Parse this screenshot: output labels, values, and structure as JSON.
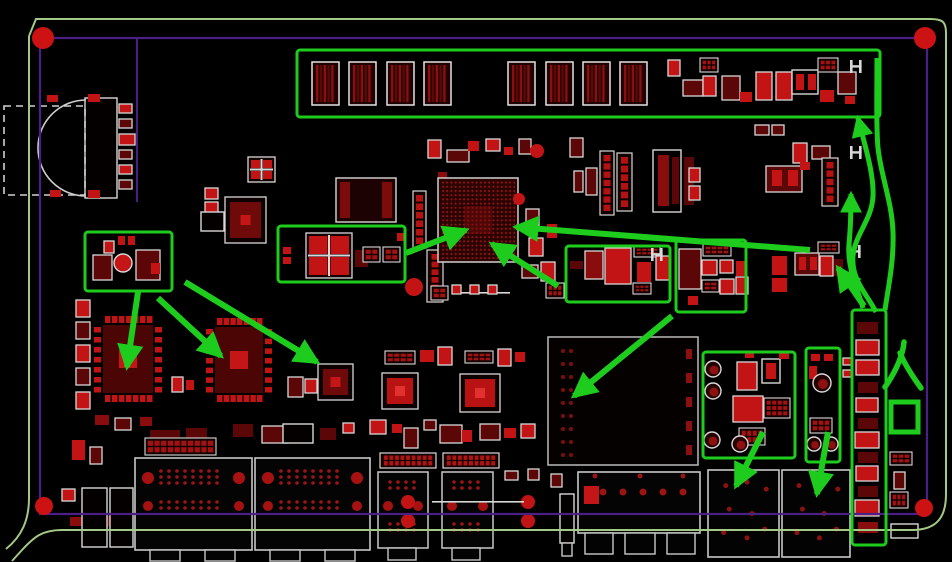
{
  "scene": {
    "width": 952,
    "height": 562,
    "background": "#000000"
  },
  "colors": {
    "annotation_green": "#1ecc1e",
    "board_outline_green": "#a4c985",
    "keepout_purple": "#4a2086",
    "pad_bright_red": "#c21414",
    "pad_mid_red": "#8a0d0d",
    "pad_dark_red": "#5c0707",
    "silk_white": "#d8d8d8",
    "hole_red": "#cc1212",
    "bga_dot_red": "#921414"
  },
  "board": {
    "outline_paths": [
      "M 29,36 L 36,19 L 930,19 C 943,19 946,22 946,33 L 946,494 C 946,516 938,530 912,530 L 62,530 C 42,530 34,537 22,550 L 12,561",
      "M 29,36 L 29,498 C 29,520 22,536 6,549"
    ],
    "keepout_rect": [
      40,
      38,
      887,
      476
    ],
    "trace_line": [
      137,
      38,
      137,
      202
    ],
    "mount_holes": [
      [
        43,
        38,
        11
      ],
      [
        925,
        38,
        11
      ],
      [
        44,
        506,
        9
      ],
      [
        924,
        508,
        9
      ]
    ]
  },
  "components": [
    [
      "wr",
      85,
      98,
      32,
      100
    ],
    [
      "arc",
      86,
      100,
      0,
      96
    ],
    [
      "dr",
      4,
      106,
      81,
      89
    ],
    [
      "p",
      88,
      94,
      12,
      8,
      1
    ],
    [
      "p",
      88,
      190,
      12,
      8,
      1
    ],
    [
      "p",
      47,
      95,
      11,
      7,
      1
    ],
    [
      "p",
      50,
      190,
      11,
      7,
      1
    ],
    [
      "w",
      119,
      104,
      13,
      9,
      1
    ],
    [
      "w",
      119,
      119,
      13,
      9,
      0
    ],
    [
      "w",
      119,
      134,
      16,
      11,
      1
    ],
    [
      "w",
      119,
      150,
      13,
      9,
      0
    ],
    [
      "w",
      119,
      165,
      13,
      9,
      1
    ],
    [
      "w",
      119,
      180,
      13,
      9,
      0
    ],
    [
      "t",
      312,
      62,
      27,
      43
    ],
    [
      "t",
      349,
      62,
      27,
      43
    ],
    [
      "t",
      387,
      62,
      27,
      43
    ],
    [
      "t",
      424,
      62,
      27,
      43
    ],
    [
      "t",
      508,
      62,
      27,
      43
    ],
    [
      "t",
      546,
      62,
      27,
      43
    ],
    [
      "t",
      583,
      62,
      27,
      43
    ],
    [
      "t",
      620,
      62,
      27,
      43
    ],
    [
      "w",
      668,
      60,
      12,
      16,
      1
    ],
    [
      "w",
      683,
      80,
      20,
      16,
      0
    ],
    [
      "g",
      700,
      58,
      18,
      14
    ],
    [
      "w",
      703,
      76,
      13,
      20,
      1
    ],
    [
      "w",
      722,
      76,
      18,
      24,
      0
    ],
    [
      "p",
      740,
      92,
      12,
      10,
      1
    ],
    [
      "w",
      756,
      72,
      16,
      28,
      1
    ],
    [
      "w",
      776,
      72,
      16,
      28,
      1
    ],
    [
      "wr",
      792,
      70,
      26,
      24
    ],
    [
      "p",
      796,
      74,
      8,
      16,
      1
    ],
    [
      "p",
      808,
      74,
      8,
      16,
      1
    ],
    [
      "g",
      818,
      58,
      20,
      14
    ],
    [
      "p",
      820,
      90,
      14,
      12,
      1
    ],
    [
      "w",
      838,
      72,
      18,
      22,
      0
    ],
    [
      "H",
      850,
      60
    ],
    [
      "p",
      845,
      96,
      10,
      8,
      1
    ],
    [
      "w",
      428,
      140,
      13,
      18,
      1
    ],
    [
      "w",
      447,
      150,
      22,
      12,
      0
    ],
    [
      "p",
      468,
      141,
      11,
      10,
      1
    ],
    [
      "w",
      486,
      139,
      14,
      12,
      1
    ],
    [
      "p",
      504,
      147,
      9,
      8,
      1
    ],
    [
      "w",
      519,
      139,
      12,
      15,
      0
    ],
    [
      "cr",
      537,
      151,
      7,
      0,
      1
    ],
    [
      "w",
      570,
      138,
      13,
      19,
      0
    ],
    [
      "x4",
      248,
      157,
      27,
      25
    ],
    [
      "w",
      205,
      188,
      13,
      11,
      1
    ],
    [
      "w",
      205,
      202,
      13,
      11,
      1
    ],
    [
      "qfn",
      225,
      197,
      41,
      46,
      0
    ],
    [
      "wr",
      201,
      212,
      23,
      19
    ],
    [
      "c2",
      336,
      178,
      60,
      44
    ],
    [
      "hv",
      413,
      191,
      13,
      57
    ],
    [
      "p",
      438,
      172,
      9,
      76,
      2
    ],
    [
      "p",
      118,
      236,
      7,
      9,
      1
    ],
    [
      "p",
      128,
      236,
      7,
      9,
      1
    ],
    [
      "cy",
      123,
      263,
      9
    ],
    [
      "w",
      93,
      255,
      19,
      25,
      0
    ],
    [
      "w",
      136,
      250,
      24,
      30,
      0
    ],
    [
      "p",
      151,
      263,
      9,
      11,
      1
    ],
    [
      "w",
      104,
      241,
      10,
      12,
      1
    ],
    [
      "w",
      76,
      300,
      14,
      17,
      1
    ],
    [
      "w",
      76,
      322,
      14,
      17,
      0
    ],
    [
      "w",
      76,
      345,
      14,
      17,
      1
    ],
    [
      "w",
      76,
      368,
      14,
      17,
      0
    ],
    [
      "w",
      76,
      392,
      14,
      17,
      1
    ],
    [
      "qfp",
      94,
      316,
      68,
      86
    ],
    [
      "qfp",
      206,
      318,
      66,
      84
    ],
    [
      "qfn",
      318,
      364,
      35,
      36,
      0
    ],
    [
      "w",
      172,
      377,
      11,
      15,
      1
    ],
    [
      "p",
      186,
      380,
      8,
      10,
      1
    ],
    [
      "w",
      288,
      377,
      15,
      20,
      0
    ],
    [
      "w",
      305,
      379,
      12,
      14,
      1
    ],
    [
      "p",
      283,
      247,
      8,
      7,
      1
    ],
    [
      "p",
      283,
      257,
      8,
      7,
      1
    ],
    [
      "x4",
      306,
      233,
      46,
      45
    ],
    [
      "p",
      355,
      250,
      13,
      17,
      0
    ],
    [
      "g",
      363,
      247,
      17,
      15
    ],
    [
      "g",
      383,
      247,
      17,
      15
    ],
    [
      "p",
      397,
      233,
      8,
      8,
      1
    ],
    [
      "cr",
      414,
      287,
      9,
      0,
      1
    ],
    [
      "hv",
      427,
      250,
      16,
      52
    ],
    [
      "bga",
      438,
      178,
      80,
      84
    ],
    [
      "w",
      526,
      209,
      13,
      22,
      0
    ],
    [
      "w",
      529,
      238,
      14,
      18,
      1
    ],
    [
      "p",
      547,
      224,
      10,
      14,
      1
    ],
    [
      "cr",
      519,
      199,
      6,
      0,
      1
    ],
    [
      "w",
      522,
      265,
      16,
      13,
      0
    ],
    [
      "w",
      541,
      262,
      14,
      19,
      1
    ],
    [
      "hv",
      600,
      151,
      14,
      64
    ],
    [
      "hv",
      617,
      153,
      15,
      58
    ],
    [
      "wr",
      653,
      150,
      28,
      62
    ],
    [
      "p",
      658,
      155,
      11,
      51,
      2
    ],
    [
      "p",
      672,
      157,
      7,
      47,
      0
    ],
    [
      "p",
      684,
      157,
      10,
      48,
      0
    ],
    [
      "w",
      689,
      168,
      11,
      14,
      1
    ],
    [
      "w",
      689,
      186,
      11,
      14,
      1
    ],
    [
      "w",
      574,
      171,
      9,
      21,
      0
    ],
    [
      "w",
      586,
      168,
      11,
      27,
      0
    ],
    [
      "ln",
      452,
      292,
      58,
      0
    ],
    [
      "g",
      431,
      286,
      17,
      14
    ],
    [
      "w",
      452,
      285,
      9,
      9,
      1
    ],
    [
      "w",
      470,
      285,
      9,
      9,
      1
    ],
    [
      "w",
      488,
      285,
      9,
      9,
      1
    ],
    [
      "g",
      546,
      283,
      18,
      15
    ],
    [
      "qfn",
      382,
      373,
      36,
      36,
      1
    ],
    [
      "qfn",
      460,
      374,
      40,
      38,
      1
    ],
    [
      "g",
      385,
      351,
      30,
      13
    ],
    [
      "p",
      420,
      350,
      14,
      12,
      1
    ],
    [
      "w",
      438,
      347,
      14,
      18,
      1
    ],
    [
      "g",
      465,
      351,
      28,
      12
    ],
    [
      "w",
      498,
      349,
      13,
      17,
      1
    ],
    [
      "p",
      515,
      352,
      10,
      10,
      1
    ],
    [
      "w",
      370,
      420,
      16,
      14,
      1
    ],
    [
      "p",
      392,
      424,
      10,
      9,
      1
    ],
    [
      "w",
      404,
      428,
      14,
      20,
      0
    ],
    [
      "w",
      424,
      420,
      12,
      10,
      0
    ],
    [
      "w",
      440,
      425,
      22,
      18,
      0
    ],
    [
      "p",
      462,
      430,
      10,
      12,
      1
    ],
    [
      "w",
      480,
      424,
      20,
      16,
      0
    ],
    [
      "p",
      504,
      428,
      12,
      10,
      1
    ],
    [
      "w",
      521,
      424,
      14,
      14,
      1
    ],
    [
      "p",
      233,
      424,
      20,
      13,
      0
    ],
    [
      "w",
      262,
      426,
      26,
      17,
      0
    ],
    [
      "wr",
      283,
      424,
      30,
      19
    ],
    [
      "p",
      320,
      428,
      16,
      12,
      0
    ],
    [
      "w",
      343,
      423,
      11,
      10,
      1
    ],
    [
      "p",
      95,
      415,
      14,
      10,
      2
    ],
    [
      "w",
      115,
      418,
      16,
      12,
      0
    ],
    [
      "p",
      140,
      417,
      12,
      9,
      2
    ],
    [
      "p",
      72,
      440,
      13,
      20,
      1
    ],
    [
      "w",
      90,
      447,
      12,
      17,
      0
    ],
    [
      "p",
      150,
      430,
      30,
      14,
      0
    ],
    [
      "p",
      186,
      428,
      21,
      13,
      0
    ],
    [
      "g",
      145,
      438,
      71,
      17
    ],
    [
      "w",
      62,
      489,
      13,
      12,
      1
    ],
    [
      "p",
      70,
      517,
      20,
      9,
      2
    ],
    [
      "cr",
      106,
      521,
      6,
      0,
      0
    ],
    [
      "cr",
      184,
      523,
      5,
      0,
      0
    ],
    [
      "wr",
      82,
      488,
      25,
      59
    ],
    [
      "wr",
      110,
      488,
      23,
      59
    ],
    [
      "sh",
      548,
      337,
      150,
      128
    ],
    [
      "p",
      570,
      261,
      13,
      8,
      0
    ],
    [
      "w",
      585,
      251,
      18,
      28,
      2
    ],
    [
      "w",
      605,
      248,
      26,
      36,
      1
    ],
    [
      "g",
      634,
      246,
      26,
      11
    ],
    [
      "p",
      637,
      262,
      14,
      20,
      1
    ],
    [
      "g",
      633,
      283,
      18,
      11
    ],
    [
      "w",
      656,
      256,
      14,
      24,
      1
    ],
    [
      "H",
      651,
      248
    ],
    [
      "w",
      679,
      249,
      22,
      40,
      0
    ],
    [
      "g",
      703,
      244,
      28,
      12
    ],
    [
      "w",
      702,
      260,
      15,
      15,
      1
    ],
    [
      "w",
      720,
      260,
      13,
      13,
      1
    ],
    [
      "p",
      736,
      261,
      10,
      15,
      1
    ],
    [
      "g",
      702,
      280,
      17,
      12
    ],
    [
      "w",
      720,
      279,
      14,
      15,
      1
    ],
    [
      "w",
      736,
      277,
      12,
      17,
      1
    ],
    [
      "p",
      688,
      296,
      10,
      9,
      1
    ],
    [
      "w",
      755,
      125,
      14,
      10,
      0
    ],
    [
      "w",
      772,
      125,
      12,
      10,
      0
    ],
    [
      "w",
      766,
      166,
      36,
      26,
      0
    ],
    [
      "p",
      772,
      170,
      10,
      16,
      1
    ],
    [
      "p",
      788,
      170,
      10,
      16,
      1
    ],
    [
      "H",
      850,
      146
    ],
    [
      "w",
      793,
      143,
      14,
      20,
      1
    ],
    [
      "w",
      812,
      146,
      18,
      13,
      0
    ],
    [
      "p",
      800,
      162,
      10,
      8,
      1
    ],
    [
      "hv",
      822,
      158,
      16,
      48
    ],
    [
      "w",
      795,
      253,
      24,
      22,
      0
    ],
    [
      "p",
      799,
      257,
      7,
      13,
      1
    ],
    [
      "p",
      810,
      257,
      7,
      13,
      1
    ],
    [
      "p",
      772,
      256,
      15,
      19,
      1
    ],
    [
      "p",
      772,
      278,
      15,
      14,
      1
    ],
    [
      "g",
      818,
      242,
      21,
      11
    ],
    [
      "w",
      820,
      256,
      13,
      20,
      1
    ],
    [
      "p",
      834,
      259,
      9,
      17,
      0
    ],
    [
      "H",
      849,
      245
    ],
    [
      "w",
      843,
      358,
      9,
      7,
      1
    ],
    [
      "w",
      843,
      370,
      9,
      7,
      1
    ],
    [
      "p",
      857,
      322,
      21,
      12,
      0
    ],
    [
      "w",
      856,
      340,
      23,
      15,
      1
    ],
    [
      "w",
      856,
      360,
      23,
      15,
      1
    ],
    [
      "p",
      858,
      382,
      20,
      11,
      0
    ],
    [
      "w",
      856,
      398,
      22,
      14,
      1
    ],
    [
      "p",
      858,
      418,
      20,
      11,
      0
    ],
    [
      "w",
      855,
      432,
      24,
      16,
      1
    ],
    [
      "p",
      858,
      452,
      20,
      11,
      0
    ],
    [
      "w",
      856,
      466,
      22,
      15,
      1
    ],
    [
      "p",
      858,
      486,
      20,
      11,
      0
    ],
    [
      "w",
      855,
      500,
      24,
      16,
      1
    ],
    [
      "p",
      858,
      522,
      20,
      11,
      2
    ],
    [
      "g",
      890,
      452,
      22,
      13
    ],
    [
      "w",
      894,
      472,
      11,
      17,
      0
    ],
    [
      "g",
      890,
      492,
      18,
      16
    ],
    [
      "wr",
      891,
      524,
      27,
      14
    ],
    [
      "wc",
      713,
      369,
      8
    ],
    [
      "wc",
      713,
      391,
      8
    ],
    [
      "w",
      737,
      362,
      20,
      28,
      1
    ],
    [
      "wr",
      762,
      359,
      18,
      24
    ],
    [
      "p",
      766,
      363,
      10,
      16,
      1
    ],
    [
      "p",
      745,
      352,
      9,
      6,
      1
    ],
    [
      "w",
      733,
      396,
      30,
      26,
      1
    ],
    [
      "g",
      764,
      398,
      26,
      20
    ],
    [
      "g",
      739,
      428,
      26,
      17
    ],
    [
      "wc",
      712,
      440,
      8
    ],
    [
      "wc",
      740,
      444,
      8
    ],
    [
      "p",
      779,
      352,
      10,
      7,
      1
    ],
    [
      "p",
      811,
      354,
      9,
      7,
      1
    ],
    [
      "p",
      824,
      354,
      9,
      7,
      1
    ],
    [
      "p",
      809,
      366,
      8,
      13,
      1
    ],
    [
      "wc",
      822,
      383,
      9
    ],
    [
      "g",
      810,
      418,
      22,
      15
    ],
    [
      "wc",
      814,
      444,
      7
    ],
    [
      "wc",
      831,
      444,
      7
    ],
    [
      "conn",
      135,
      458,
      117,
      92
    ],
    [
      "conn",
      255,
      458,
      115,
      92
    ],
    [
      "tab",
      150,
      550,
      30,
      11
    ],
    [
      "tab",
      205,
      550,
      30,
      11
    ],
    [
      "tab",
      270,
      550,
      30,
      11
    ],
    [
      "tab",
      325,
      550,
      30,
      11
    ],
    [
      "c5",
      378,
      472,
      50,
      76
    ],
    [
      "c5",
      442,
      472,
      51,
      76
    ],
    [
      "tab",
      388,
      548,
      28,
      12
    ],
    [
      "tab",
      452,
      548,
      28,
      12
    ],
    [
      "h2",
      380,
      453,
      56,
      15
    ],
    [
      "h2",
      443,
      453,
      56,
      15
    ],
    [
      "w",
      505,
      471,
      13,
      9,
      0
    ],
    [
      "w",
      528,
      469,
      11,
      11,
      0
    ],
    [
      "w",
      551,
      474,
      11,
      13,
      0
    ],
    [
      "cr",
      408,
      502,
      7,
      0,
      1
    ],
    [
      "cr",
      408,
      521,
      7,
      0,
      1
    ],
    [
      "cr",
      528,
      502,
      7,
      0,
      1
    ],
    [
      "cr",
      528,
      521,
      7,
      0,
      1
    ],
    [
      "ln",
      432,
      501,
      92,
      0
    ],
    [
      "wr",
      560,
      494,
      14,
      49
    ],
    [
      "tab",
      562,
      543,
      10,
      13
    ],
    [
      "usb",
      578,
      472,
      122,
      61
    ],
    [
      "tab",
      585,
      533,
      28,
      21
    ],
    [
      "tab",
      625,
      533,
      30,
      21
    ],
    [
      "tab",
      667,
      533,
      28,
      21
    ],
    [
      "c6",
      708,
      470,
      71,
      87
    ],
    [
      "c6",
      782,
      470,
      68,
      87
    ]
  ],
  "annotations": {
    "highlight_boxes": [
      [
        297,
        50,
        583,
        67
      ],
      [
        85,
        232,
        87,
        59
      ],
      [
        278,
        226,
        127,
        56
      ],
      [
        566,
        246,
        104,
        56
      ],
      [
        676,
        240,
        70,
        72
      ],
      [
        703,
        352,
        92,
        106
      ],
      [
        806,
        348,
        34,
        114
      ],
      [
        852,
        310,
        34,
        235
      ]
    ],
    "arrows": [
      [
        138,
        292,
        127,
        367
      ],
      [
        158,
        298,
        221,
        356
      ],
      [
        185,
        282,
        317,
        362
      ],
      [
        406,
        253,
        466,
        230
      ],
      [
        810,
        250,
        516,
        227
      ],
      [
        558,
        286,
        492,
        244
      ],
      [
        672,
        316,
        574,
        396
      ],
      [
        763,
        432,
        736,
        486
      ],
      [
        828,
        432,
        817,
        494
      ],
      [
        864,
        306,
        838,
        268
      ]
    ],
    "curved_arrows": [
      {
        "d": "M 876,312 C 867,294 851,280 853,256 C 855,234 872,220 873,196 C 874,174 865,146 858,118",
        "head": true
      },
      {
        "d": "M 863,308 C 858,290 847,268 849,244 C 851,224 851,210 851,194",
        "head": true
      },
      {
        "d": "M 885,310 C 888,288 894,262 893,232 C 892,202 881,176 878,148 C 876,128 877,96 877,58",
        "head": false
      }
    ],
    "entry_label": {
      "text": "入口",
      "strokes": [
        "M 904,342 C 903,354 897,370 885,387",
        "M 900,353 C 905,365 913,377 921,388"
      ],
      "box": [
        891,
        402,
        27,
        30
      ]
    }
  }
}
